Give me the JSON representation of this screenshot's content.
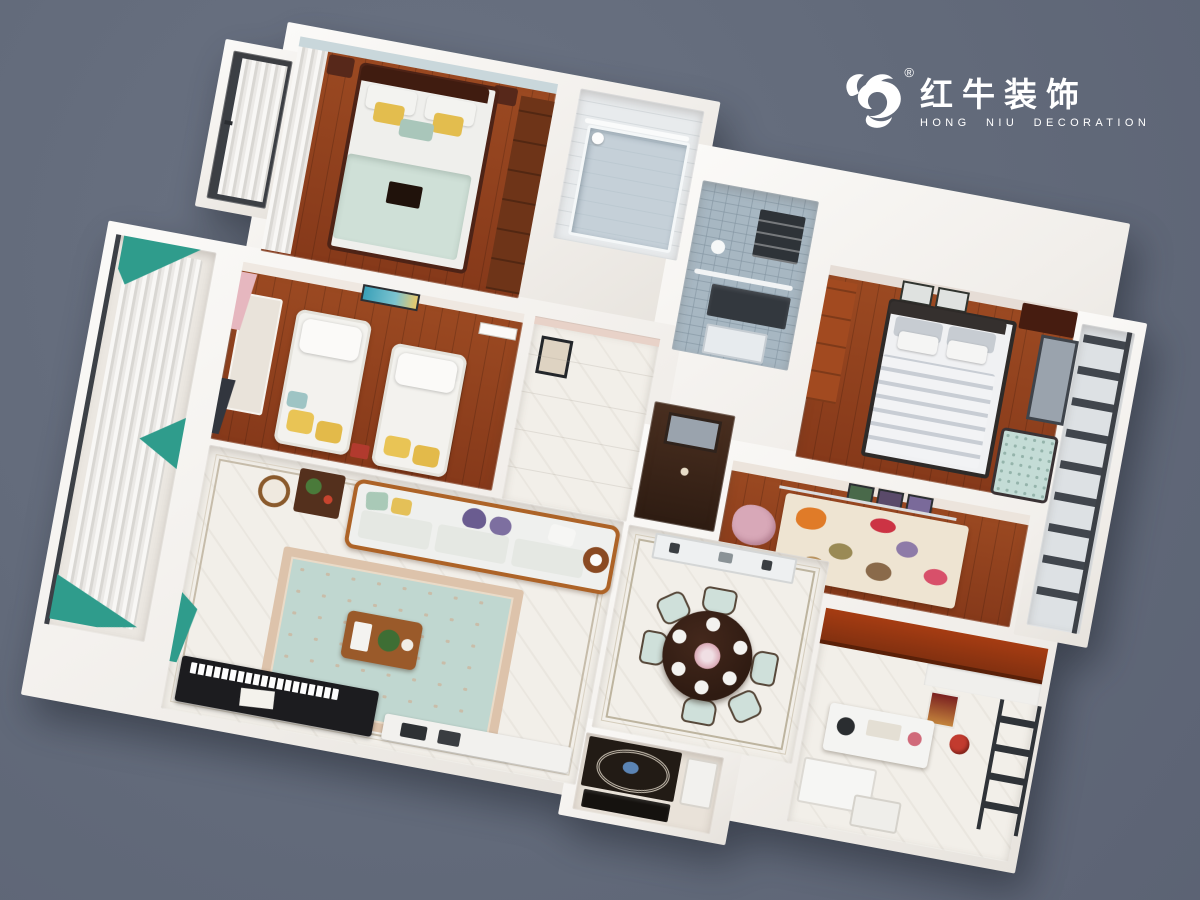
{
  "logo": {
    "icon": "bull-logo-icon",
    "registered_mark": "®",
    "brand_cn": "红牛装饰",
    "brand_en": "HONG NIU DECORATION",
    "text_color": "#ffffff"
  },
  "scene": {
    "description": "3D isometric apartment floor plan render, rotated clockwise",
    "background_color": "#626a7a",
    "rotation_deg": 10.5,
    "palette": {
      "wall_white": "#f4f1ed",
      "wood_floor": "#8a3f1d",
      "marble_floor": "#f2efe9",
      "tile_blue": "#a7b7c2",
      "cabinet_red_wood": "#a03c12",
      "rug_teal": "#c0d7d0",
      "rug_border_beige": "#ddc3ab",
      "rug_cream": "#eee4d2",
      "curtain_teal": "#2f9c8c",
      "curtain_pink": "#e6b7bf",
      "bedding_mint": "#cfe0d7",
      "bedding_white": "#f2f3f5",
      "pillow_yellow": "#e3bd4e",
      "pillow_purple": "#6a5c90",
      "piano_black": "#1c1c1f",
      "dining_table_wood": "#2f1b12",
      "foyer_floor_dark": "#221b15",
      "foyer_accent_blue": "#5b84b4",
      "rack_metal": "#41464d"
    }
  }
}
